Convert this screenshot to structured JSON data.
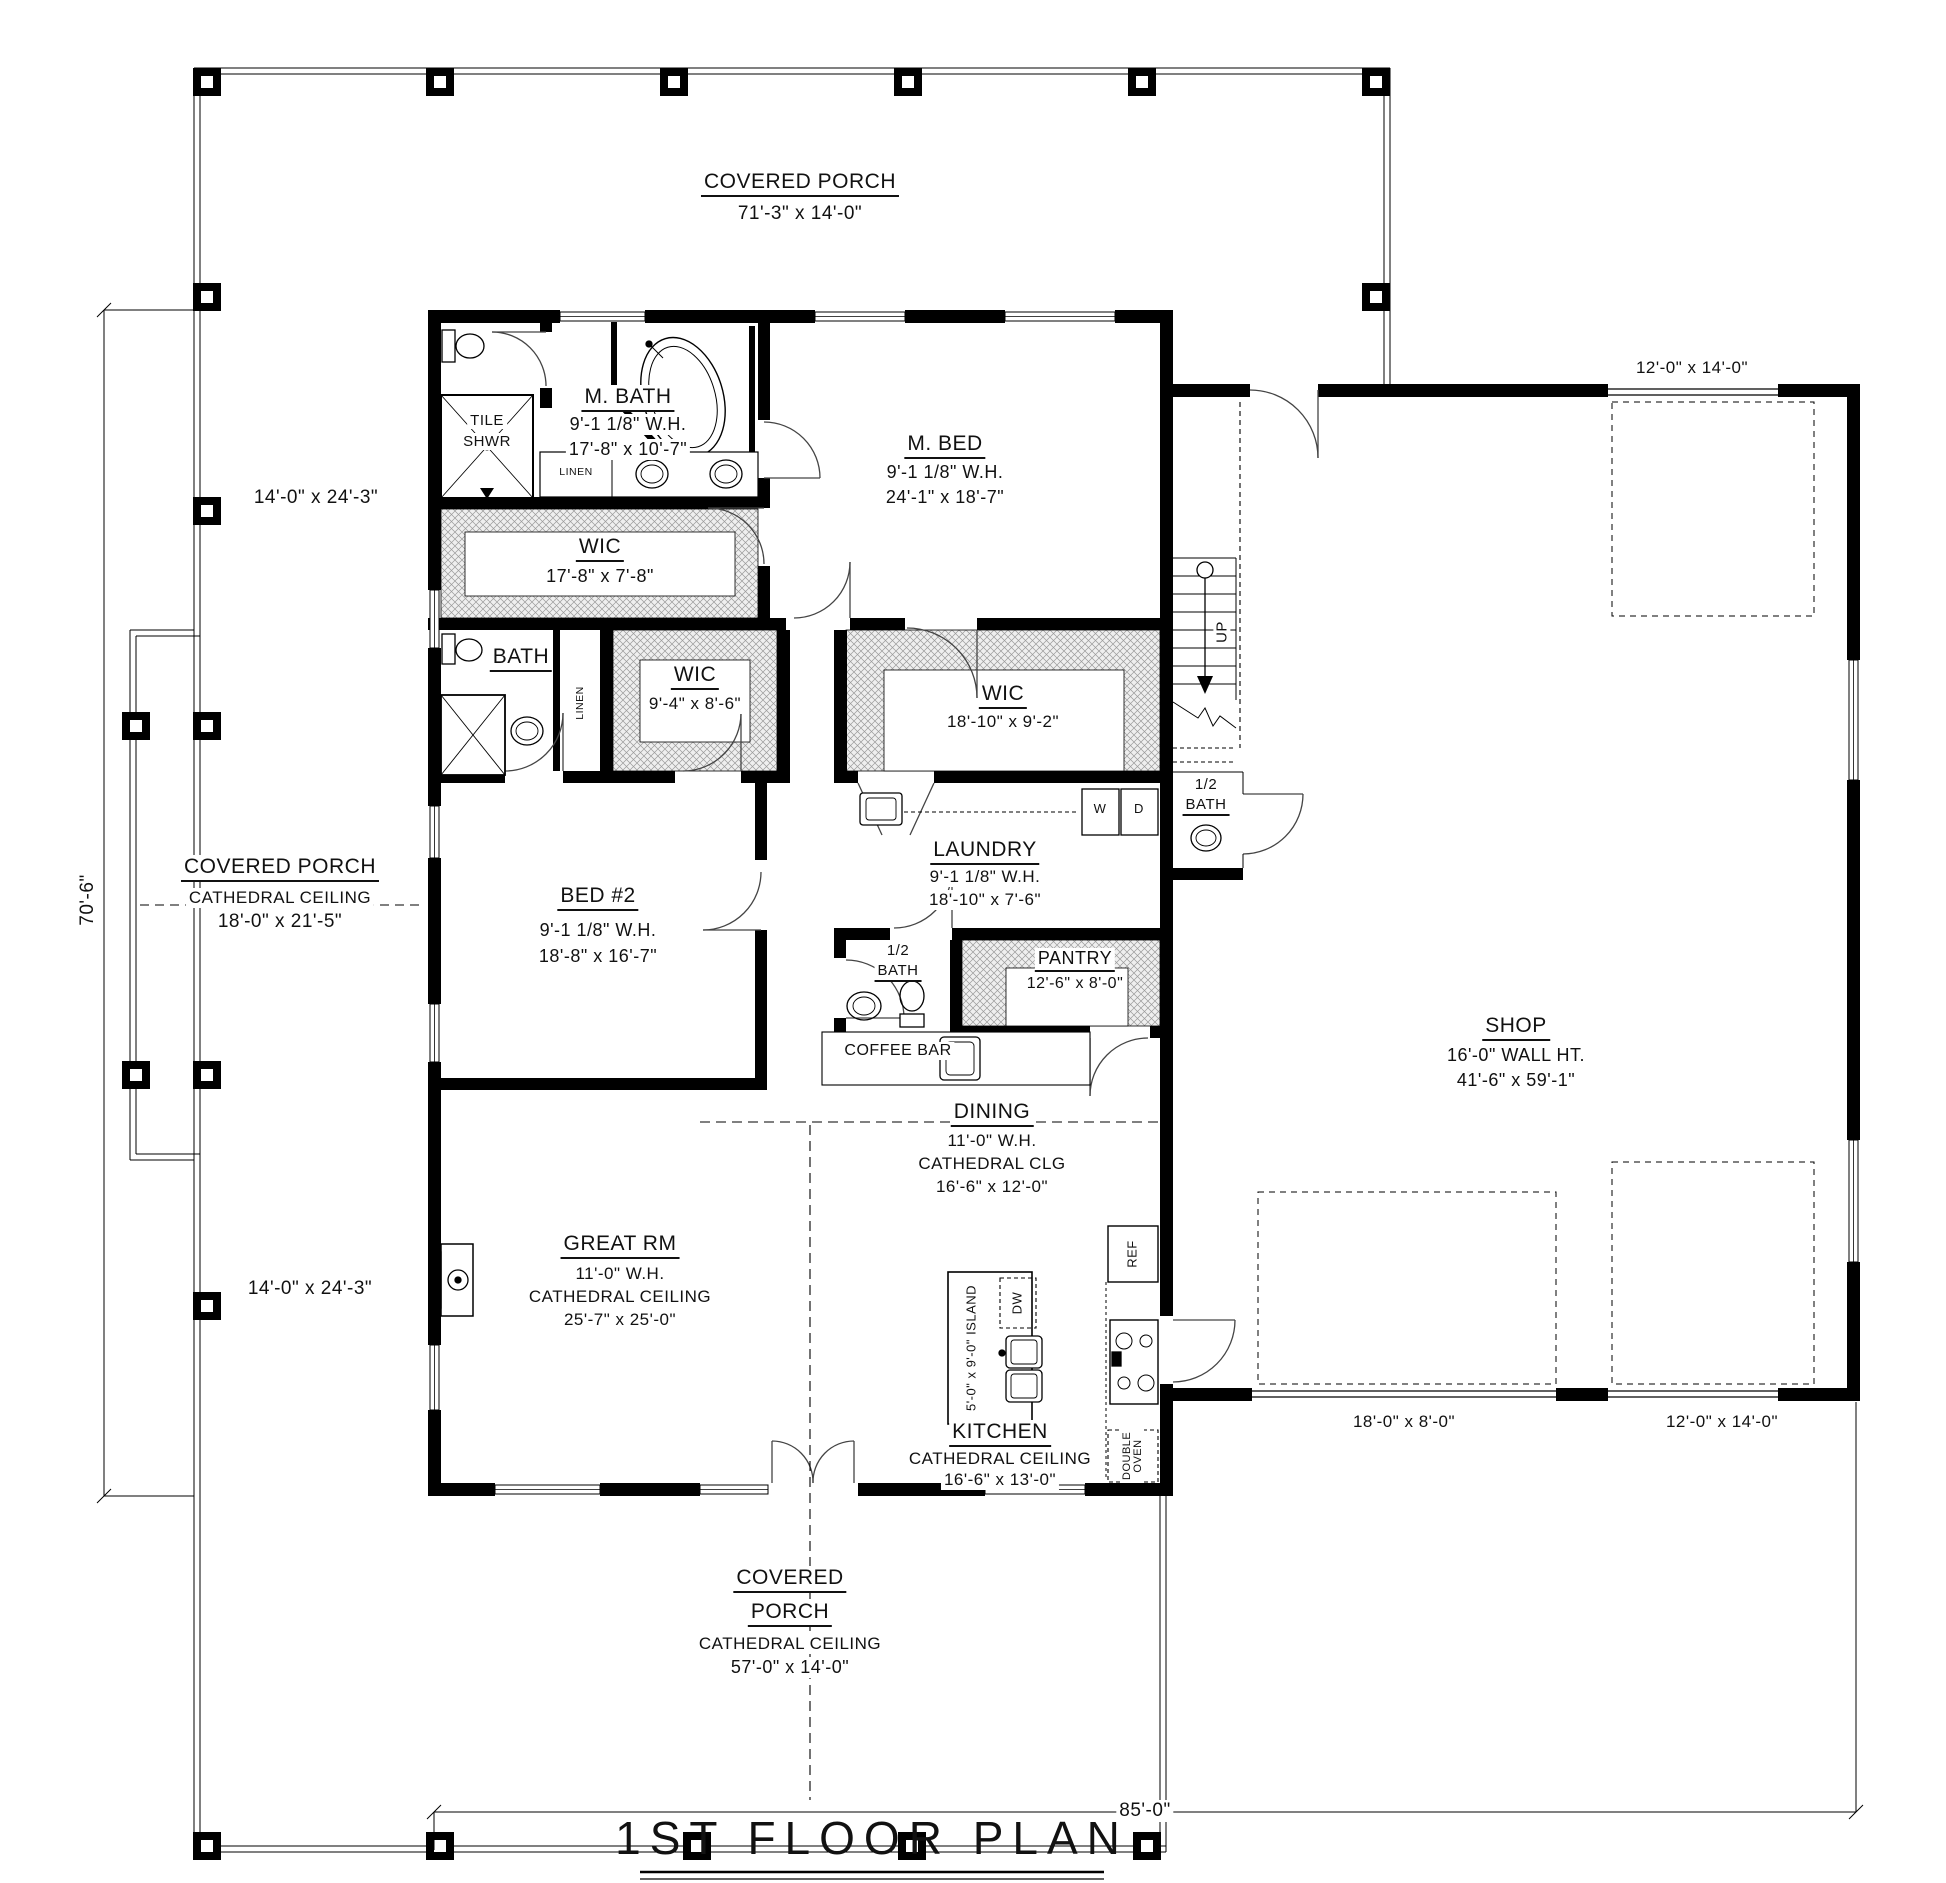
{
  "drawing_title": "1ST FLOOR PLAN",
  "porch_top": {
    "name": "COVERED PORCH",
    "size": "71'-3\" x 14'-0\""
  },
  "porch_left": {
    "name": "COVERED PORCH",
    "ceiling": "CATHEDRAL CEILING",
    "size": "18'-0\" x 21'-5\""
  },
  "porch_bottom": {
    "name_line1": "COVERED",
    "name_line2": "PORCH",
    "ceiling": "CATHEDRAL CEILING",
    "size": "57'-0\" x 14'-0\""
  },
  "rooms": {
    "m_bath": {
      "name": "M. BATH",
      "wall_height": "9'-1 1/8\" W.H.",
      "size": "17'-8\" x 10'-7\""
    },
    "m_bed": {
      "name": "M. BED",
      "wall_height": "9'-1 1/8\" W.H.",
      "size": "24'-1\" x 18'-7\""
    },
    "wic_master": {
      "name": "WIC",
      "size": "17'-8\" x 7'-8\""
    },
    "bath": {
      "name": "BATH"
    },
    "wic_2": {
      "name": "WIC",
      "size": "9'-4\" x 8'-6\""
    },
    "wic_3": {
      "name": "WIC",
      "size": "18'-10\" x 9'-2\""
    },
    "laundry": {
      "name": "LAUNDRY",
      "wall_height": "9'-1 1/8\" W.H.",
      "size": "18'-10\" x 7'-6\""
    },
    "bed_2": {
      "name": "BED #2",
      "wall_height": "9'-1 1/8\" W.H.",
      "size": "18'-8\" x 16'-7\""
    },
    "half_bath_main": {
      "line1": "1/2",
      "line2": "BATH"
    },
    "half_bath_stairs": {
      "line1": "1/2",
      "line2": "BATH"
    },
    "pantry": {
      "name": "PANTRY",
      "size": "12'-6\" x 8'-0\""
    },
    "dining": {
      "name": "DINING",
      "wall_height": "11'-0\" W.H.",
      "ceiling": "CATHEDRAL CLG",
      "size": "16'-6\" x 12'-0\""
    },
    "great_room": {
      "name": "GREAT RM",
      "wall_height": "11'-0\" W.H.",
      "ceiling": "CATHEDRAL CEILING",
      "size": "25'-7\" x 25'-0\""
    },
    "kitchen": {
      "name": "KITCHEN",
      "ceiling": "CATHEDRAL CEILING",
      "size": "16'-6\" x 13'-0\""
    },
    "shop": {
      "name": "SHOP",
      "wall_height": "16'-0\" WALL HT.",
      "size": "41'-6\" x 59'-1\""
    }
  },
  "fixtures": {
    "tile_shower_line1": "TILE",
    "tile_shower_line2": "SHWR",
    "linen_master": "LINEN",
    "linen_hall": "LINEN",
    "coffee_bar": "COFFEE BAR",
    "island": "5'-0\" x 9'-0\" ISLAND",
    "dishwasher": "DW",
    "refrigerator": "REF",
    "double_oven": "DOUBLE OVEN",
    "washer": "W",
    "dryer": "D",
    "stairs_up": "UP"
  },
  "dimensions": {
    "overall_width": "85'-0\"",
    "overall_depth": "70'-6\"",
    "porch_upper_left": "14'-0\" x 24'-3\"",
    "porch_lower_left": "14'-0\" x 24'-3\"",
    "shop_door_top": "12'-0\" x 14'-0\"",
    "shop_door_bottom_left": "18'-0\" x 8'-0\"",
    "shop_door_bottom_right": "12'-0\" x 14'-0\""
  }
}
